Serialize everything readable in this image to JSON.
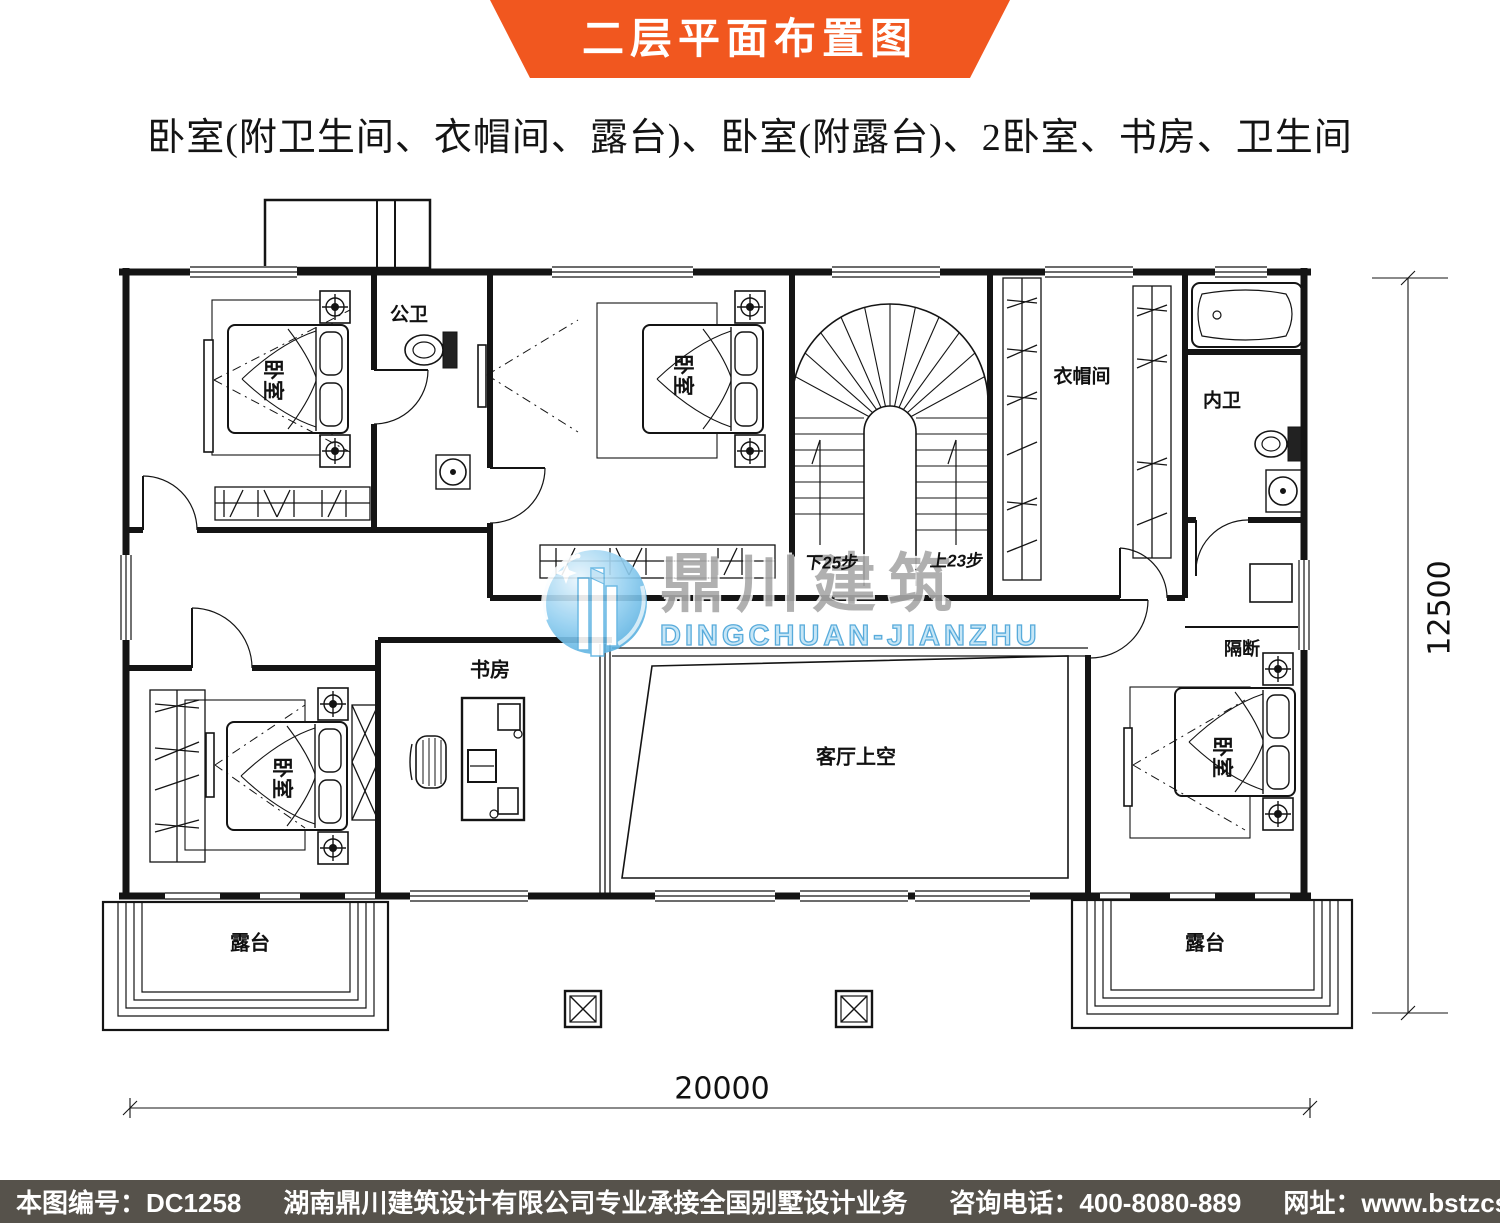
{
  "header": {
    "title": "二层平面布置图",
    "accent_color": "#f1571f"
  },
  "subtitle": "卧室(附卫生间、衣帽间、露台)、卧室(附露台)、2卧室、书房、卫生间",
  "plan": {
    "labels": {
      "bedroom_top_left": "卧室",
      "public_bath": "公卫",
      "bedroom_top_mid": "卧室",
      "cloakroom": "衣帽间",
      "inner_bath": "内卫",
      "bedroom_bottom_left": "卧室",
      "study": "书房",
      "living_void": "客厅上空",
      "partition": "隔断",
      "bedroom_bottom_right": "卧室",
      "terrace_left": "露台",
      "terrace_right": "露台",
      "stairs_down": "下25步",
      "stairs_up": "上23步"
    },
    "dimensions": {
      "width": "20000",
      "height": "12500"
    }
  },
  "watermark": {
    "name_cn": "鼎川建筑",
    "name_en": "DINGCHUAN-JIANZHU",
    "accent_blue": "#46a3d8"
  },
  "footer": {
    "drawing_no": "本图编号：DC1258",
    "company": "湖南鼎川建筑设计有限公司专业承接全国别墅设计业务",
    "phone": "咨询电话：400-8080-889",
    "website": "网址：www.bstzcs.com",
    "bg": "#56524b"
  }
}
